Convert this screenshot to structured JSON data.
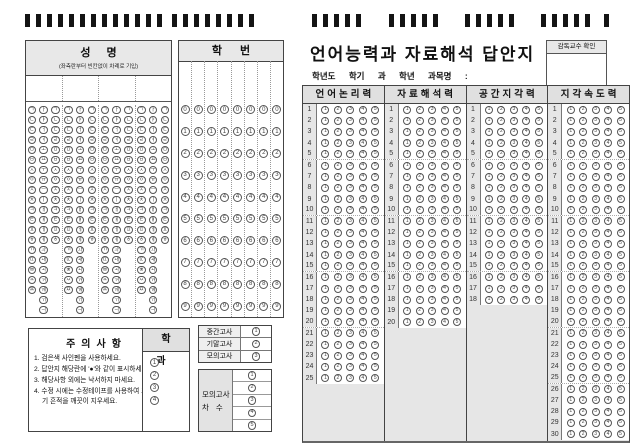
{
  "colors": {
    "header_fill": "#e0e0e0",
    "filler_fill": "#e6e6e6",
    "border": "#444444",
    "mark": "#141414"
  },
  "timing_marks": {
    "groups": [
      13,
      8,
      5,
      5,
      5,
      5,
      1
    ]
  },
  "name_section": {
    "title": "성명",
    "subtitle": "(좌측란부터 빈칸없이 차례로 기입)",
    "syllable_groups": 4,
    "initial_consonants": [
      "ㄱ",
      "ㄴ",
      "ㄷ",
      "ㄹ",
      "ㅁ",
      "ㅂ",
      "ㅅ",
      "ㅇ",
      "ㅈ",
      "ㅊ",
      "ㅋ",
      "ㅌ",
      "ㅍ",
      "ㅎ",
      "ㄲ",
      "ㄸ",
      "ㅃ",
      "ㅆ",
      "ㅉ"
    ],
    "vowels": [
      "ㅏ",
      "ㅑ",
      "ㅓ",
      "ㅕ",
      "ㅗ",
      "ㅛ",
      "ㅜ",
      "ㅠ",
      "ㅡ",
      "ㅣ",
      "ㅐ",
      "ㅒ",
      "ㅔ",
      "ㅖ",
      "ㅘ",
      "ㅙ",
      "ㅚ",
      "ㅝ",
      "ㅞ",
      "ㅟ",
      "ㅢ"
    ],
    "final_consonants": [
      "ㄱ",
      "ㄴ",
      "ㄷ",
      "ㄹ",
      "ㅁ",
      "ㅂ",
      "ㅅ",
      "ㅇ",
      "ㅈ",
      "ㅊ",
      "ㅋ",
      "ㅌ",
      "ㅍ",
      "ㅎ"
    ]
  },
  "id_section": {
    "title": "학번",
    "columns": 8,
    "digits": [
      "0",
      "1",
      "2",
      "3",
      "4",
      "5",
      "6",
      "7",
      "8",
      "9"
    ]
  },
  "sheet": {
    "title": "언어능력과 자료해석 답안지",
    "proctor_label": "감독교수 확인",
    "info_line": "학년도 학기 과 학년 과목명 :"
  },
  "answer_section": {
    "choices": [
      "1",
      "2",
      "3",
      "4",
      "5"
    ],
    "columns": [
      {
        "label": "언어논리력",
        "questions": 25
      },
      {
        "label": "자료해석력",
        "questions": 20
      },
      {
        "label": "공간지각력",
        "questions": 18
      },
      {
        "label": "지각속도력",
        "questions": 30
      }
    ]
  },
  "notice": {
    "title": "주의사항",
    "items": [
      "1. 검은색 사인펜을 사용하세요.",
      "2. 답안지 해당란에 '●'와 같이 표시하세요.",
      "3. 해당사항 외에는 낙서하지 마세요.",
      "4. 수정 시에는 수정테이프를 사용하여 표기 흔적을 깨끗이 지우세요."
    ]
  },
  "department": {
    "title": "학과",
    "options": [
      "1",
      "2",
      "3",
      "4"
    ]
  },
  "exam_type": {
    "rows": [
      {
        "label": "중간고사",
        "value": "1"
      },
      {
        "label": "기말고사",
        "value": "2"
      },
      {
        "label": "모의고사",
        "value": "3"
      }
    ]
  },
  "mock_round": {
    "label_line1": "모의고사",
    "label_line2": "차수",
    "options": [
      "1",
      "2",
      "3",
      "4",
      "5"
    ]
  }
}
